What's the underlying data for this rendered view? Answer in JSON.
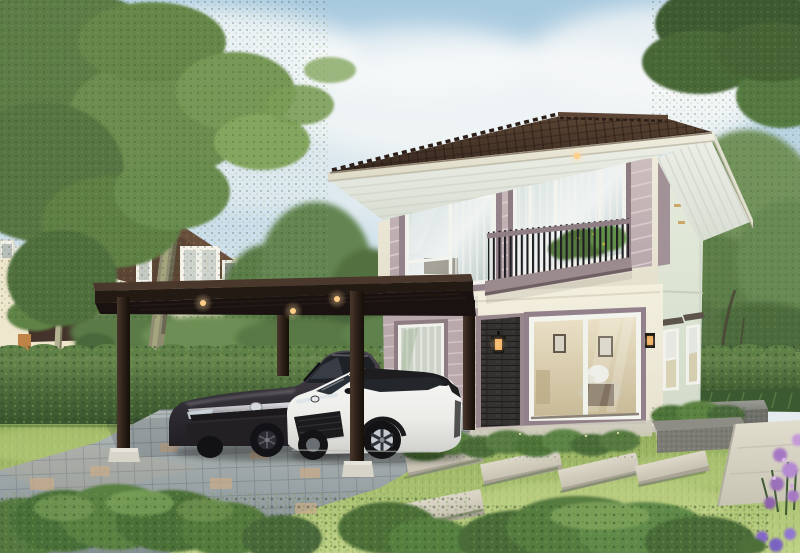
{
  "scene": {
    "description": "3D architectural rendering: modern two-story cream house with dark hip roof, mauve siding band, balcony, dark steel carport sheltering a charcoal sedan and a white SUV, paver driveway, lawn with stepping stones, hedges, trees and a neighboring house",
    "no_visible_text": true,
    "labels": {
      "sky": "daytime sky with soft clouds",
      "background_trees": "background trees",
      "left_tree": "tall tree with mossy trunk",
      "neighbor_house": "neighboring cream house with brown hip roof",
      "hedge": "trimmed green hedge wall",
      "main_house": "two-story main house",
      "roof": "dark brown tiled hip roof",
      "balcony": "second floor balcony with black railing and plants",
      "brick_column": "dark brick accent column with wall lantern",
      "sliding_door": "large glass sliding door with warm interior",
      "carport": "dark steel flat-roof carport with downlights",
      "sedan": "charcoal gray sedan",
      "suv": "white crossover SUV with black roof",
      "driveway": "gray paver driveway",
      "lawn": "front lawn",
      "stepping_stones": "concrete stepping slabs across lawn",
      "garden": "right garden with bench, planter, path and purple flowers"
    },
    "palette": {
      "sky_blue": "#a7c9df",
      "cloud": "#f6f8f8",
      "house_wall_cream": "#f1eddd",
      "house_wall_side": "#dfe7d8",
      "siding_band_mauve": "#bcabaf",
      "window_trim": "#8d7c82",
      "roof_tile_brown": "#3f2e23",
      "fascia": "#eceadb",
      "soffit": "#e9ece4",
      "brick_dark": "#343230",
      "lantern_glow": "#ffb459",
      "carport_steel": "#241a14",
      "downlight": "#ffc575",
      "sedan_charcoal": "#38333a",
      "suv_white": "#f2f2ef",
      "suv_roof_black": "#1d1d20",
      "hedge_green": "#4d6b3b",
      "lawn_green": "#a8c06b",
      "driveway_gray": "#9aa1a5",
      "paver_tan": "#c7ab8a",
      "slab_concrete": "#d6d1c2",
      "bench_concrete": "#80807a",
      "flower_purple": "#a678c4"
    }
  }
}
